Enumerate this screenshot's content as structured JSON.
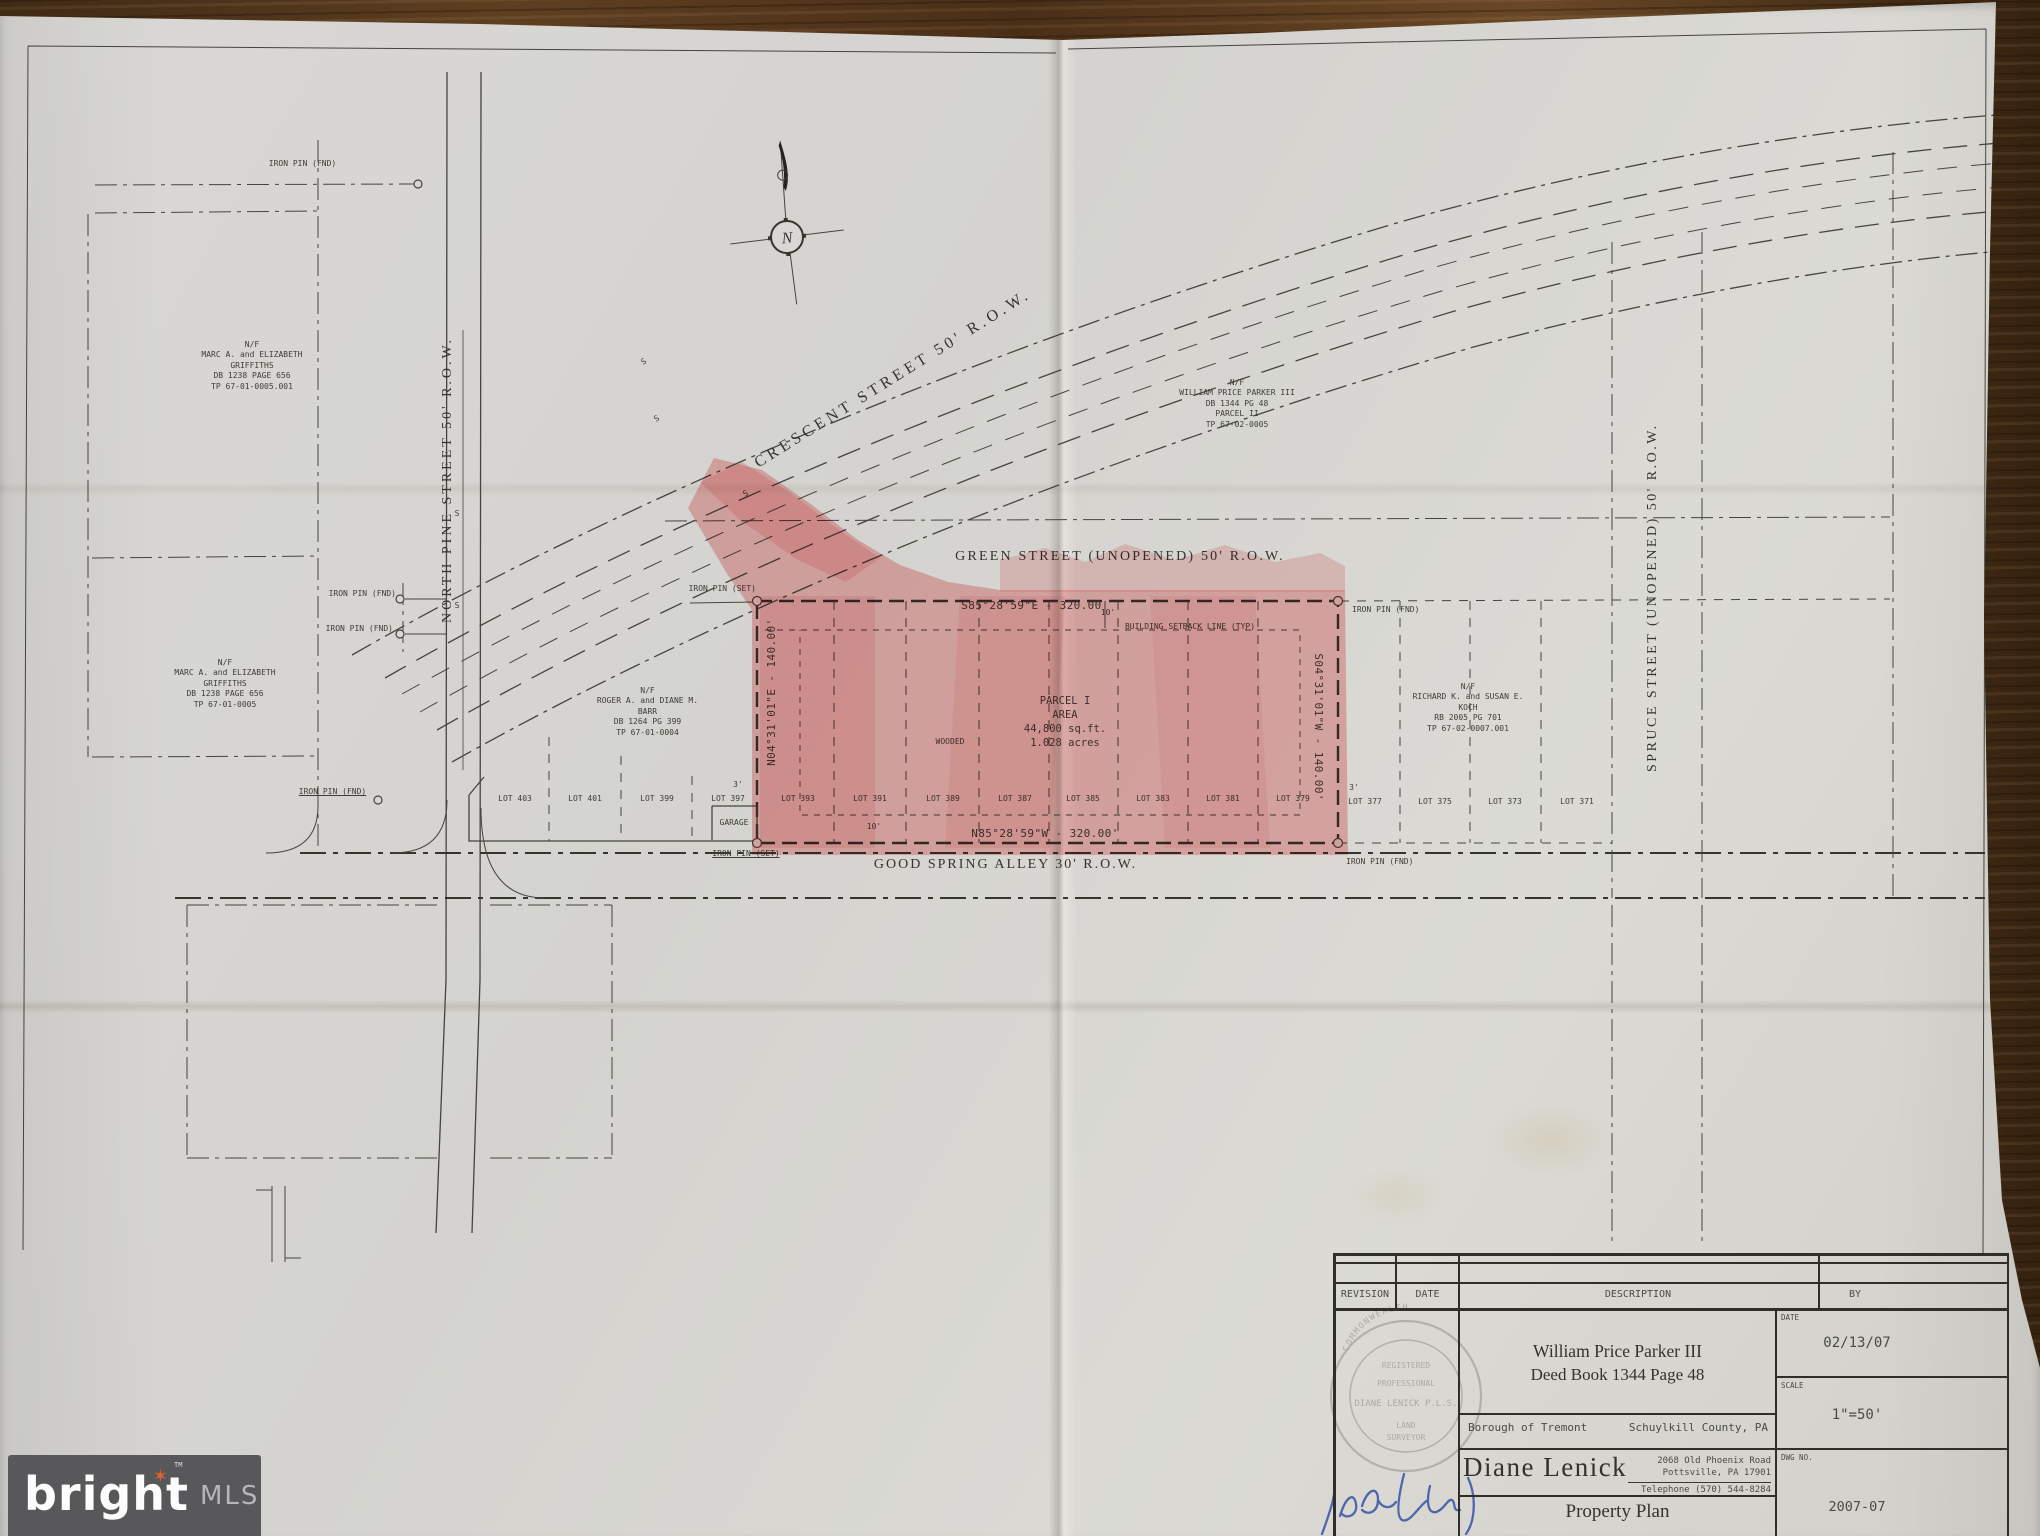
{
  "labels": {
    "iron_pin_fnd": "IRON PIN (FND)",
    "iron_pin_set": "IRON PIN (SET)",
    "garage": "GARAGE",
    "wooded": "WOODED",
    "sewer_mark": "S",
    "north": "N",
    "dim_10": "10'",
    "dim_3": "3'"
  },
  "streets": {
    "north_pine": "NORTH PINE STREET 50' R.O.W.",
    "crescent": "CRESCENT STREET 50' R.O.W.",
    "green": "GREEN STREET (UNOPENED) 50' R.O.W.",
    "spruce": "SPRUCE STREET (UNOPENED) 50' R.O.W.",
    "good_spring": "GOOD SPRING ALLEY  30' R.O.W."
  },
  "parcel": {
    "block": "PARCEL I\nAREA\n44,800 sq.ft.\n1.028 acres",
    "bearing_top": "S85°28'59\"E - 320.00'",
    "bearing_bottom": "N85°28'59\"W - 320.00'",
    "bearing_left": "N04°31'01\"E - 140.00'",
    "bearing_right": "S04°31'01\"W - 140.00'",
    "setback": "BUILDING SETBACK LINE (TYP)"
  },
  "owners": {
    "griffiths_north": "N/F\nMARC A. and ELIZABETH\nGRIFFITHS\nDB 1238  PAGE 656\nTP 67-01-0005.001",
    "griffiths_south": "N/F\nMARC A. and ELIZABETH\nGRIFFITHS\nDB 1238  PAGE 656\nTP 67-01-0005",
    "parker": "N/F\nWILLIAM PRICE PARKER III\nDB 1344  PG 48\nPARCEL II\nTP 67-02-0005",
    "barr": "N/F\nROGER A. and DIANE M.\nBARR\nDB 1264  PG 399\nTP 67-01-0004",
    "koch": "N/F\nRICHARD K. and SUSAN E.\nKOCH\nRB 2005  PG 701\nTP 67-02-0007.001"
  },
  "lots": [
    "LOT 403",
    "LOT 401",
    "LOT 399",
    "LOT 397",
    "LOT 393",
    "LOT 391",
    "LOT 389",
    "LOT 387",
    "LOT 385",
    "LOT 383",
    "LOT 381",
    "LOT 379",
    "LOT 377",
    "LOT 375",
    "LOT 373",
    "LOT 371"
  ],
  "titleblock": {
    "headers": {
      "revision": "REVISION",
      "date": "DATE",
      "description": "DESCRIPTION",
      "by": "BY"
    },
    "date_label": "DATE",
    "date_value": "02/13/07",
    "scale_label": "SCALE",
    "scale_value": "1\"=50'",
    "dwg_label": "DWG NO.",
    "dwg_value": "2007-07",
    "client_line1": "William Price Parker III",
    "client_line2": "Deed Book 1344   Page 48",
    "borough": "Borough of Tremont",
    "county": "Schuylkill County, PA",
    "surveyor_name": "Diane Lenick",
    "address": "2068 Old Phoenix Road\nPottsville, PA   17901",
    "phone": "Telephone (570) 544-8284",
    "plan_title": "Property Plan",
    "seal_arc": "COMMONWEALTH",
    "seal_line0": "REGISTERED",
    "seal_line1": "PROFESSIONAL",
    "seal_line2": "DIANE LENICK P.L.S.",
    "seal_line3": "LAND",
    "seal_line4": "SURVEYOR"
  },
  "watermark": {
    "brand": "bright",
    "tm": "TM",
    "suffix": "MLS"
  },
  "colors": {
    "highlight": "#f27f7f",
    "paper": "#d8d6d1",
    "ink": "#3c3c38",
    "wood": "#5d4026",
    "logo_bg": "#58585a",
    "logo_star": "#e8622c",
    "signature": "#3d57a8"
  }
}
